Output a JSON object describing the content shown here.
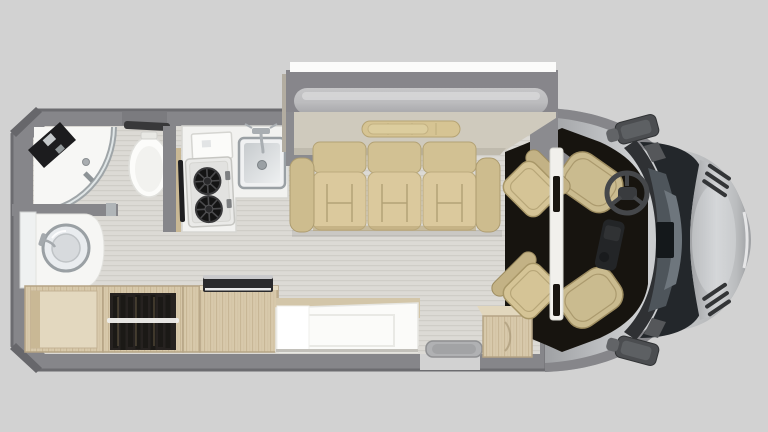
{
  "scene": {
    "type": "rv-motorhome-floor-plan-top-view",
    "rear_left_rooms": {
      "bathroom": [
        "corner-shower",
        "shower-glass-door",
        "shower-fixture-panel",
        "shower-drain",
        "toilet",
        "towel-bar",
        "vanity-counter",
        "vanity-sink-bowl",
        "vanity-faucet",
        "vanity-door-panel"
      ],
      "kitchen": [
        "l-shaped-counter",
        "flip-up-shelf",
        "two-burner-cooktop",
        "cooktop-handle",
        "kitchen-sink",
        "kitchen-faucet",
        "partition-wall"
      ]
    },
    "lounge": {
      "slide_out": [
        "slide-out-exterior-strip",
        "slide-out-box",
        "awning-roll",
        "rear-shelf",
        "oval-tray"
      ],
      "sofa": [
        "left-armrest",
        "back-cushion-1",
        "back-cushion-2",
        "back-cushion-3",
        "seat-cushion-1",
        "seat-cushion-2",
        "seat-cushion-3",
        "right-armrest"
      ]
    },
    "storage_row": [
      "base-cabinet",
      "wardrobe-with-hanging-clothes",
      "clothes-rail",
      "narrow-cabinet",
      "tv-cabinet",
      "flat-tv"
    ],
    "bed": [
      "bed-base",
      "mattress",
      "pillow"
    ],
    "entry": [
      "door-opening",
      "electric-entry-step",
      "entry-step-box"
    ],
    "cab": [
      "swivel-seat-rear-left-upper",
      "swivel-seat-rear-left-lower",
      "cab-seat-driver",
      "cab-seat-passenger",
      "b-pillar",
      "center-console",
      "steering-wheel",
      "dashboard",
      "windshield",
      "rearview-mirror-block",
      "hood",
      "hood-vent-upper",
      "hood-vent-lower",
      "side-mirror-top",
      "side-mirror-bottom"
    ]
  },
  "colors": {
    "background": "#d2d2d2",
    "wall": "#86868a",
    "wall_trim": "#6c6c70",
    "floor": "#dcdad5",
    "floor_line": "#cfcdc7",
    "white": "#f6f6f4",
    "chrome": "#9aa0a4",
    "steel_dark": "#7b8185",
    "wood": "#d8c9ab",
    "wood_grain": "#c8b796",
    "wood_edge": "#b5a485",
    "wood_light": "#e3d8bf",
    "clothes": "#1b1916",
    "clothes_bg": "#262220",
    "rail": "#f0efec",
    "tan": "#d5c496",
    "tan_mid": "#cabb8f",
    "tan_dark": "#a89768",
    "sofa": "#dbc99d",
    "sofa_back": "#d2c193",
    "sofa_line": "#b3a276",
    "sofa_shadow": "#b7a577",
    "table": "#cfcabd",
    "table_edge": "#bfbaad",
    "tray": "#d6c493",
    "tray_line": "#bfae7e",
    "awning_light": "#c6c6c8",
    "awning_dark": "#a7a7aa",
    "slide_white": "#fbfbfa",
    "slide_gray": "#87868b",
    "cab_dark": "#17140f",
    "pillar": "#f1f0ec",
    "windshield": "#23272b",
    "glass_mid": "#4e555b",
    "glass_light": "#6e767d",
    "dash": "#2f3134",
    "wheel": "#45474a",
    "silver_light": "#cfd1d3",
    "silver": "#b9bbbd",
    "silver_dark": "#9fa1a4",
    "mirror": "#4b4d50",
    "mirror_inner": "#5d6063",
    "step": "#b0b1b3",
    "step_inner": "#a2a3a5",
    "bed": "#fbfbf9",
    "pillow": "#ffffff",
    "fixture": "#1c1c1e"
  }
}
